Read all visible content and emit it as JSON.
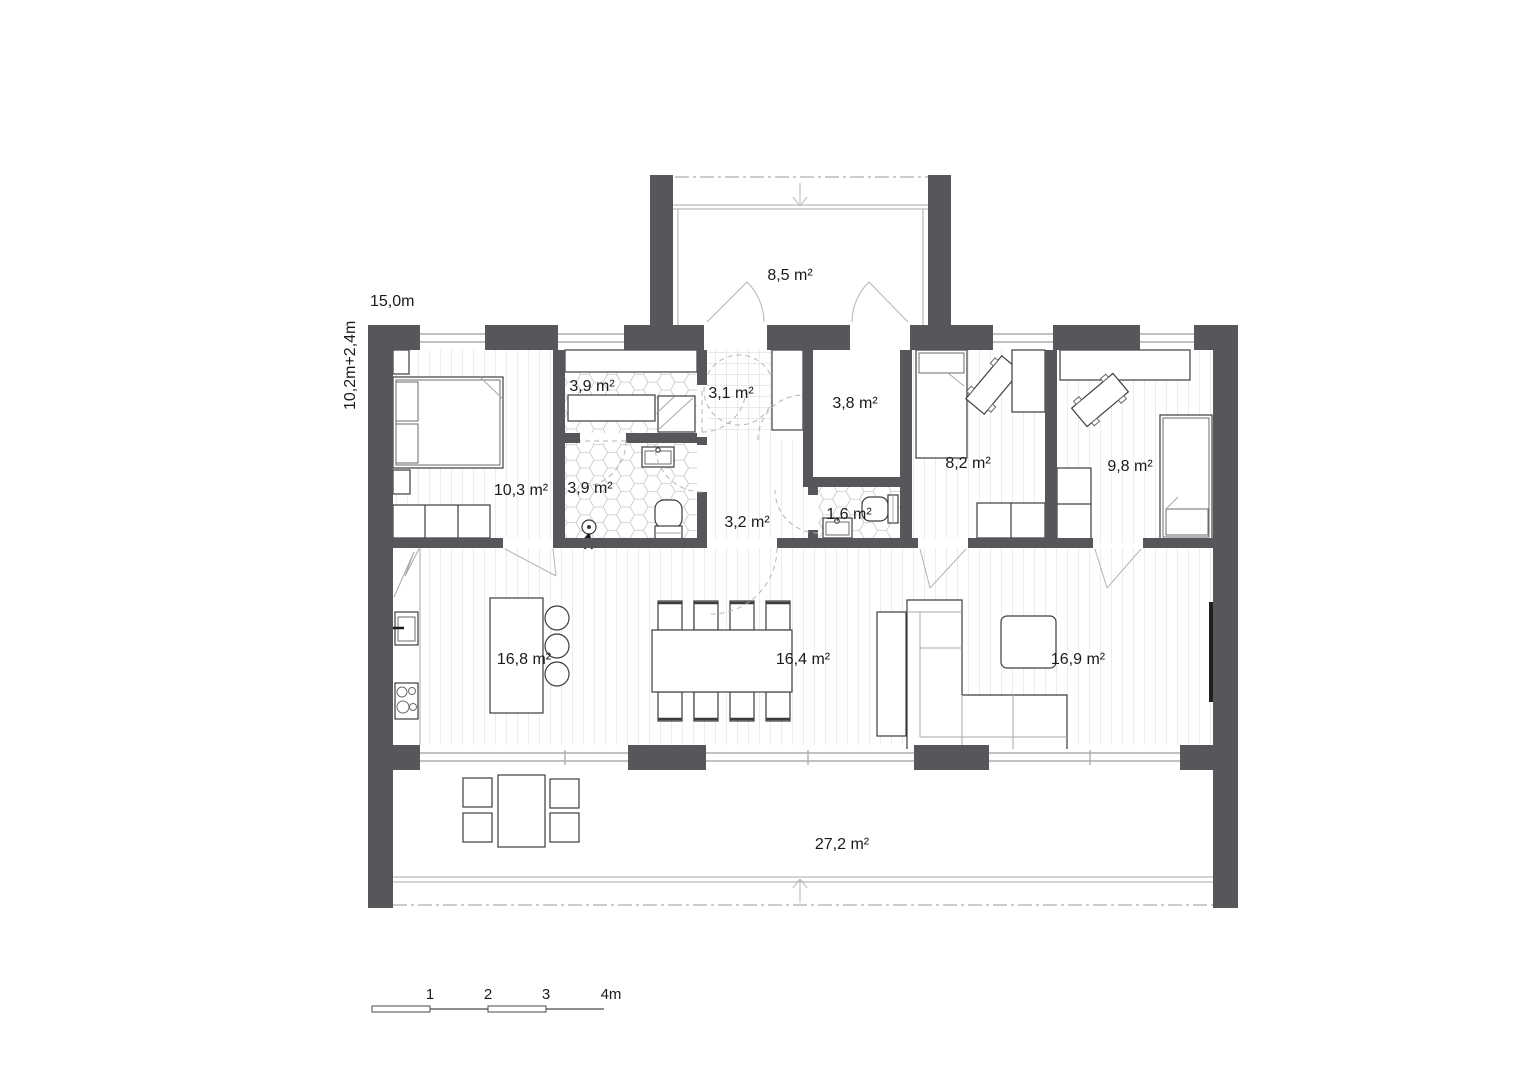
{
  "plan": {
    "dimensions": {
      "width_label": "15,0m",
      "depth_label": "10,2m+2,4m"
    },
    "rooms": [
      {
        "name": "entrance-porch",
        "area": "8,5 m²"
      },
      {
        "name": "utility-room",
        "area": "3,9 m²"
      },
      {
        "name": "entry-hall",
        "area": "3,1 m²"
      },
      {
        "name": "storage-room",
        "area": "3,8 m²"
      },
      {
        "name": "kids-room-1",
        "area": "8,2 m²"
      },
      {
        "name": "kids-room-2",
        "area": "9,8 m²"
      },
      {
        "name": "master-bedroom",
        "area": "10,3 m²"
      },
      {
        "name": "bathroom",
        "area": "3,9 m²"
      },
      {
        "name": "corridor",
        "area": "3,2 m²"
      },
      {
        "name": "wc",
        "area": "1,6 m²"
      },
      {
        "name": "kitchen",
        "area": "16,8 m²"
      },
      {
        "name": "dining-room",
        "area": "16,4 m²"
      },
      {
        "name": "living-room",
        "area": "16,9 m²"
      },
      {
        "name": "terrace",
        "area": "27,2 m²"
      }
    ],
    "scale_bar": {
      "labels": [
        "1",
        "2",
        "3",
        "4m"
      ]
    },
    "colors": {
      "wall": "#57575b",
      "floor_line": "#d9d9d9",
      "tile_line": "#c8c8c8",
      "text": "#1a1a1a"
    }
  }
}
